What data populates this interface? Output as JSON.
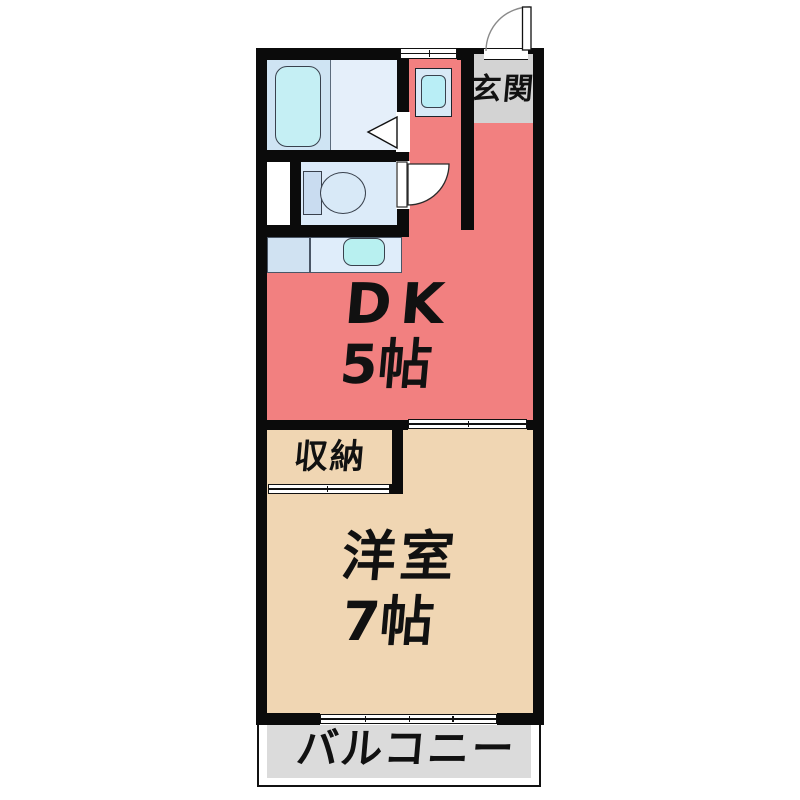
{
  "plan_title": "1DK floor plan",
  "rooms": {
    "dk": {
      "name": "DK",
      "size": "5帖",
      "floor_color": "#f28080"
    },
    "western": {
      "name": "洋室",
      "size": "7帖",
      "floor_color": "#f0d6b3"
    },
    "closet": {
      "name": "収納",
      "floor_color": "#f0a254"
    },
    "entrance": {
      "name": "玄関",
      "mat_color": "#d3d3d3"
    },
    "balcony": {
      "name": "バルコニー",
      "floor_color": "#dbdbdb"
    }
  },
  "fixtures": {
    "bathtub": "bathtub",
    "toilet": "toilet-bowl-and-tank",
    "kitchen_sink": "kitchen-counter-sink",
    "washing_machine": "washing-machine-pan",
    "entrance_door": "hinged-door-swing",
    "toilet_door": "hinged-door-swing",
    "bathroom_door": "door-triangle-marker",
    "balcony_window": "4-panel-sliding-window",
    "dk_partition": "sliding-door",
    "closet_door": "sliding-door",
    "top_window": "small-sliding-window"
  },
  "colors": {
    "wall": "#0b0b0b",
    "background": "#ffffff",
    "bath_zone_left": "#cfe4f3",
    "bath_zone_right": "#e5effa",
    "tub_cyan": "#c5eff4",
    "toilet_room_blue": "#dcebf9",
    "counter_blue": "#d0e2f2",
    "sink_cyan": "#b8f0f0",
    "washer_pan_blue": "#d8e9f6"
  }
}
